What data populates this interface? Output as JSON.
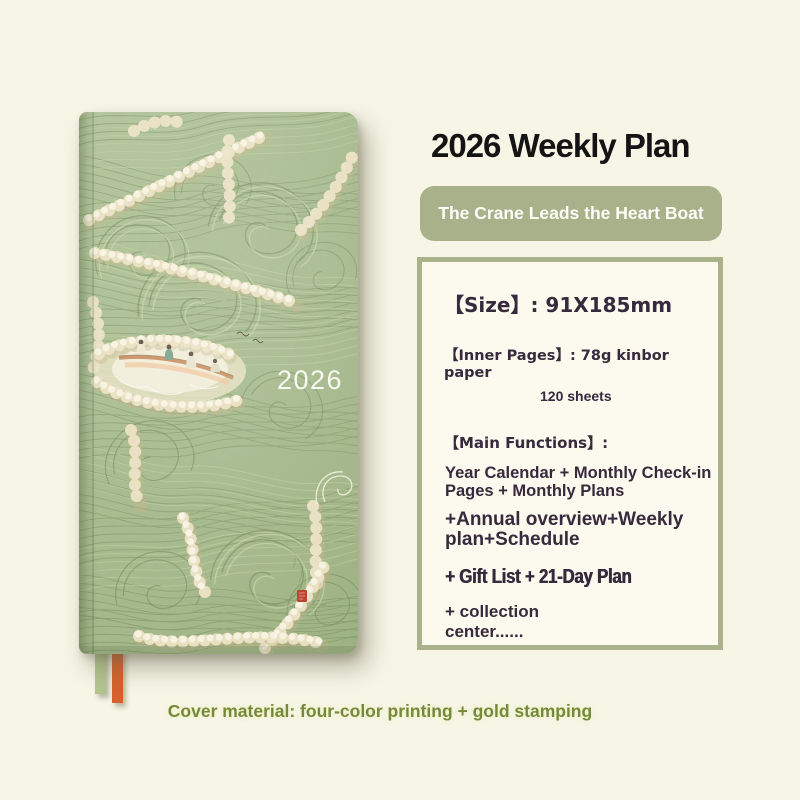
{
  "page": {
    "background_color": "#f6f5e6",
    "caption": "Cover material: four-color printing + gold stamping",
    "caption_color": "#76893b"
  },
  "product": {
    "title": "2026 Weekly Plan",
    "title_color": "#141414",
    "tagline": "The Crane Leads the Heart Boat",
    "tagline_bg_color": "#a9b18a",
    "tagline_text_color": "#fdfdf8",
    "cover": {
      "year_text": "2026",
      "base_green": "#a5b98c",
      "foam_cream": "#ebe2c4",
      "seal_red": "#b53b27",
      "boat_hull_color": "#c98f62",
      "ribbon_green": "#b2c48f",
      "ribbon_orange": "#d7602b"
    }
  },
  "specs": {
    "border_color": "#a9b28b",
    "background_color": "#fcfaee",
    "text_color": "#372a3d",
    "size": "【Size】: 91X185mm",
    "inner_pages": "【Inner Pages】: 78g kinbor paper",
    "sheet_count": "120 sheets",
    "main_functions_label": "【Main Functions】:",
    "functions": [
      "Year Calendar + Monthly Check-in Pages + Monthly Plans",
      "+Annual overview+Weekly plan+Schedule",
      "+ Gift List + 21-Day Plan",
      "+ collection center......"
    ]
  }
}
